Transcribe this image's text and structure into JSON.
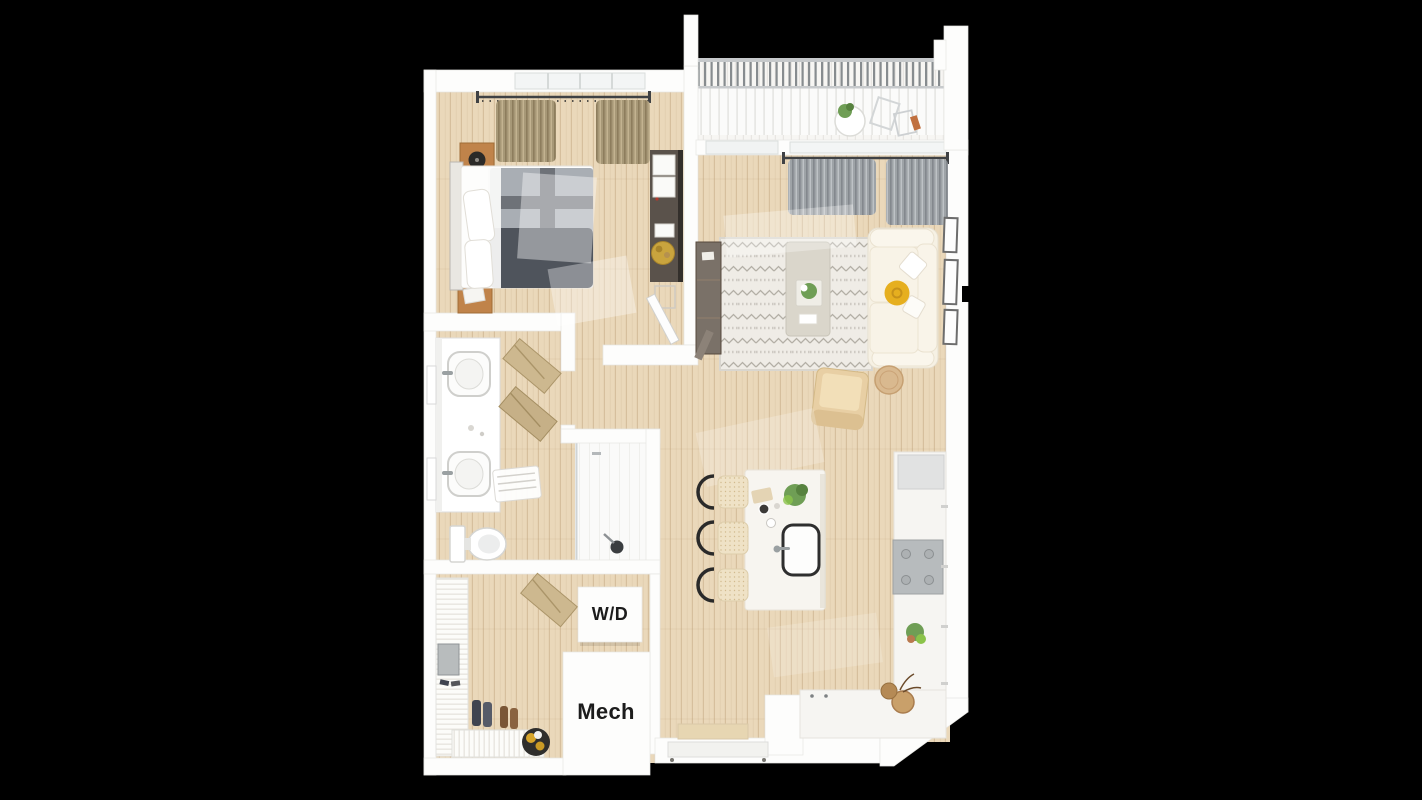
{
  "scene": {
    "type": "3d-floor-plan-top-down-rendering",
    "background": "#000000"
  },
  "labels": {
    "washer_dryer": "W/D",
    "mechanical": "Mech"
  },
  "palette": {
    "wall": "#fdfdfc",
    "floor_wood": "#ead8ba",
    "balcony_deck": "#f7f6f3",
    "railing": "#878c8f",
    "curtain_tan": "#a79877",
    "curtain_gray": "#9ea3a7",
    "bed_sheet": "#fdfdfc",
    "duvet_light": "#a9aeb4",
    "duvet_cross": "#6e7278",
    "duvet_dark": "#4f545c",
    "headboard": "#e9e7e2",
    "nightstand": "#c0834a",
    "dresser": "#5a524b",
    "gold_tray": "#c9a43e",
    "sofa": "#f6f1e4",
    "sofa_cushion": "#f9f4e9",
    "pillow_yellow": "#e6af1f",
    "rug": "#efece6",
    "rug_pattern": "#b3afa6",
    "tv_console": "#7a7168",
    "armchair": "#e8cfa4",
    "side_table": "#d9b98f",
    "island": "#f7f5f0",
    "sink_outline": "#2e2e2e",
    "stool_seat": "#efe2c6",
    "stool_frame": "#2a2a2a",
    "range": "#b7bbbd",
    "counter": "#f6f5f2",
    "cabinet_gray": "#e1e2e2",
    "plant": "#6f9e55",
    "plant_dark": "#57823f",
    "basket": "#c9a06a",
    "vanity": "#ffffff",
    "fixture": "#9aa0a2",
    "mat_gray": "#b8bcbd",
    "entry_mat": "#e7d6b2",
    "boots_dark": "#3f4450",
    "boots_brown": "#7a5636",
    "label_text": "#1c1c1c"
  },
  "rooms": [
    {
      "name": "bedroom",
      "furniture": [
        "bed",
        "duvet",
        "pillows",
        "headboard",
        "nightstand-top",
        "nightstand-bottom",
        "record-player",
        "dresser",
        "gold-tray",
        "curtains",
        "window"
      ]
    },
    {
      "name": "balcony",
      "furniture": [
        "railing",
        "bistro-table",
        "potted-plant",
        "chairs"
      ]
    },
    {
      "name": "living-room",
      "furniture": [
        "sofa",
        "yellow-pillow",
        "throw-pillows",
        "rug",
        "coffee-table",
        "tv-console",
        "armchair",
        "side-table",
        "wall-frames",
        "curtains",
        "window",
        "balcony-doorway"
      ]
    },
    {
      "name": "kitchen",
      "furniture": [
        "island",
        "island-sink",
        "faucet",
        "bar-stools",
        "range-cooktop",
        "counter-run",
        "upper-cabinet",
        "plants",
        "baskets"
      ]
    },
    {
      "name": "bathroom",
      "furniture": [
        "double-vanity",
        "sinks",
        "towel-ladder",
        "bath-mat",
        "toilet",
        "wall-towels",
        "shower",
        "shower-head"
      ]
    },
    {
      "name": "entry-laundry",
      "furniture": [
        "slatted-shelf",
        "door-mat",
        "boots",
        "bench-slats",
        "round-basket",
        "leaning-rack",
        "washer-dryer-unit",
        "entry-door",
        "entry-floor-mat"
      ]
    },
    {
      "name": "mechanical-room",
      "furniture": []
    }
  ]
}
